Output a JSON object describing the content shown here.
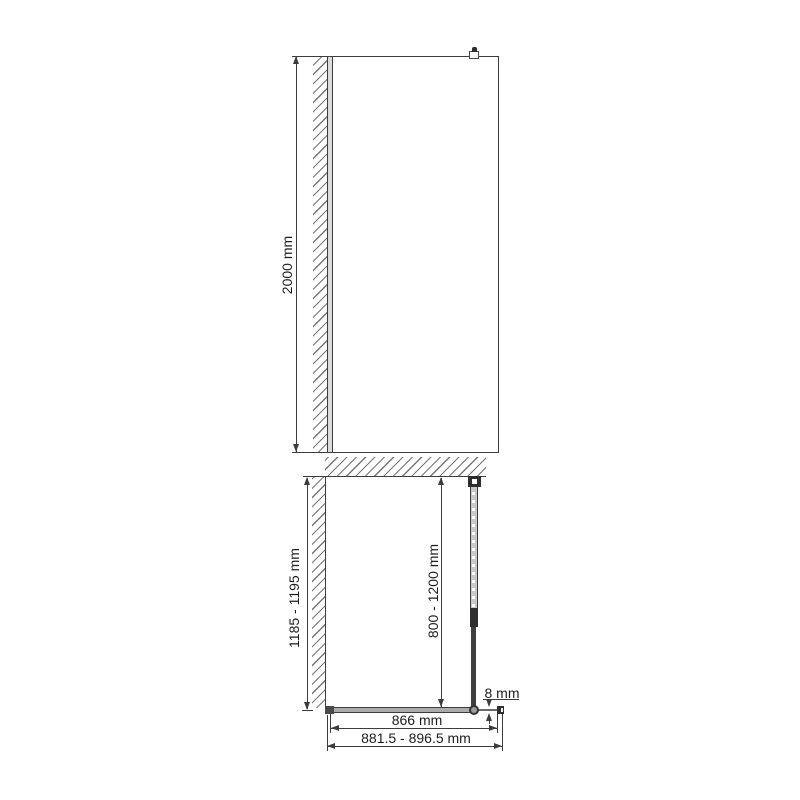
{
  "front_view": {
    "height_label": "2000 mm"
  },
  "plan_view": {
    "depth_label": "1185 - 1195 mm",
    "support_bar_label": "800 - 1200 mm",
    "glass_thickness_label": "8 mm",
    "glass_width_label": "866 mm",
    "overall_width_label": "881.5 - 896.5 mm"
  },
  "colors": {
    "line": "#3c3c3c",
    "text": "#1d1d1d",
    "hatch": "#767676",
    "wall_profile_fill": "#dcdcdc",
    "glass_fill": "#ababab",
    "support_tube_fill": "#c8c8c8",
    "hardware_dark": "#2e2e2e",
    "background": "#ffffff"
  }
}
